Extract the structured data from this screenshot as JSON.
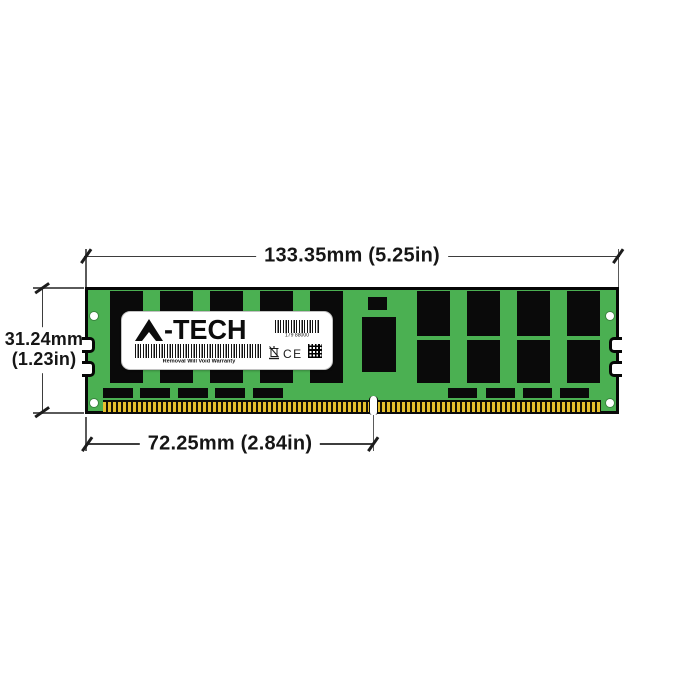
{
  "figure": {
    "colors": {
      "pcb_green": "#4bb052",
      "chip_black": "#0a0a0a",
      "pin_gold": "#e6c02e",
      "dimension_line": "#3d3d3d"
    },
    "dimensions": {
      "width_label": "133.35mm (5.25in)",
      "height_label_line1": "31.24mm",
      "height_label_line2": "(1.23in)",
      "key_offset_label": "72.25mm (2.84in)"
    },
    "label": {
      "brand": "A-TECH",
      "brand_suffix": "-TECH",
      "serial": "179 88000",
      "warranty": "Removal Will Void Warranty",
      "ce": "CE"
    }
  }
}
